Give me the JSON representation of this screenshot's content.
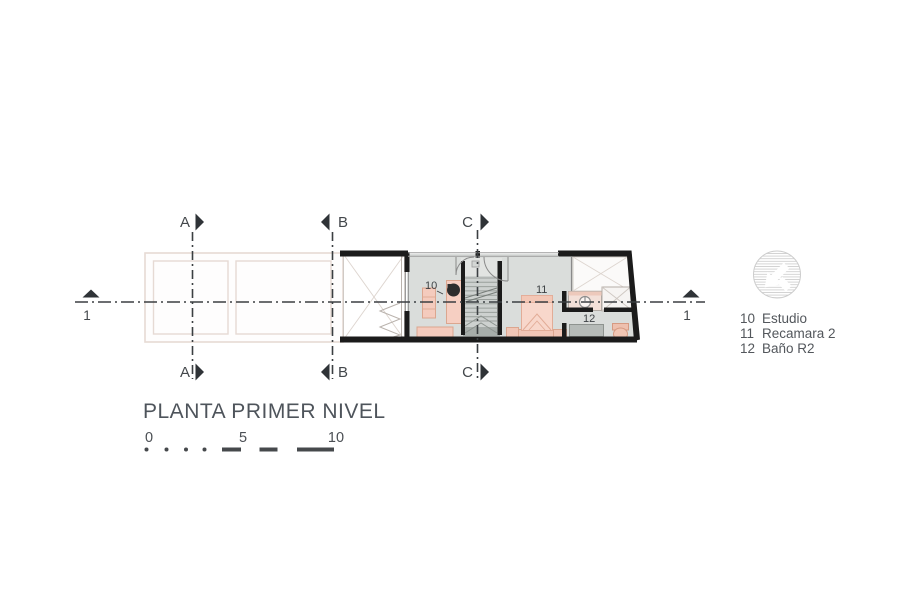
{
  "title": "PLANTA PRIMER NIVEL",
  "scale_bar": {
    "t0": "0",
    "t5": "5",
    "t10": "10"
  },
  "sections": {
    "a": "A",
    "b": "B",
    "c": "C",
    "axis1": "1"
  },
  "room_labels": {
    "estudio": "10",
    "recamara": "11",
    "bano": "12"
  },
  "legend": {
    "items": [
      {
        "num": "10",
        "name": "Estudio"
      },
      {
        "num": "11",
        "name": "Recamara 2"
      },
      {
        "num": "12",
        "name": "Baño R2"
      }
    ]
  },
  "colors": {
    "wall": "#1b1b1b",
    "floor": "#dadddb",
    "furniture_fill": "#f4cbbd",
    "furniture_outline": "#dba68f",
    "section_line": "#3b3f42",
    "light_outline": "#e6dad4",
    "text": "#53575c"
  }
}
